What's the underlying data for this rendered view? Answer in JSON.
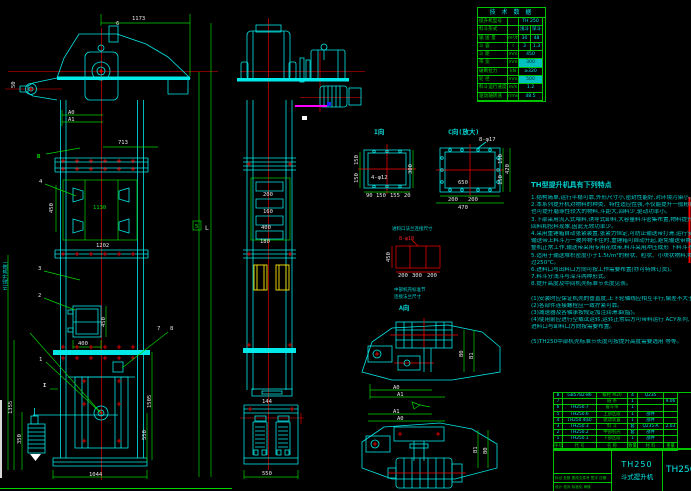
{
  "tech_table": {
    "title": "技 术 数 据",
    "rows": [
      {
        "label": "提升机型号",
        "unit": "",
        "v1": "TH 250",
        "v2": "",
        "span": true,
        "hl": false
      },
      {
        "label": "料斗形式",
        "unit": "",
        "v1": "浅斗",
        "v2": "深斗",
        "span": false,
        "hl": false
      },
      {
        "label": "输 送 量",
        "unit": "m³/h",
        "v1": "30",
        "v2": "48",
        "span": false,
        "hl": false
      },
      {
        "label": "斗  容",
        "unit": "l",
        "v1": "3",
        "v2": "1.3",
        "span": false,
        "hl": false
      },
      {
        "label": "斗  距",
        "unit": "mm",
        "v1": "450",
        "v2": "",
        "span": true,
        "hl": false
      },
      {
        "label": "带  宽",
        "unit": "mm",
        "v1": "300",
        "v2": "",
        "span": true,
        "hl": true
      },
      {
        "label": "破断拉力",
        "unit": "kN",
        "v1": "≥320",
        "v2": "",
        "span": true,
        "hl": false
      },
      {
        "label": "轮  径",
        "unit": "mm",
        "v1": "500",
        "v2": "",
        "span": true,
        "hl": true
      },
      {
        "label": "料斗运行速度",
        "unit": "m/s",
        "v1": "1.2",
        "v2": "",
        "span": true,
        "hl": false
      },
      {
        "label": "驱动轴转速",
        "unit": "r/min",
        "v1": "48.5",
        "v2": "",
        "span": true,
        "hl": false
      }
    ]
  },
  "features": {
    "title": "TH型提升机具有下列特点",
    "lines": [
      "1.结构简单,运行平稳可靠,外形尺寸小,密封性能好,对环境污染小。",
      "2.本系列提升机对物料的种类、特性适应性强,不仅能提升一般粉状、粒状物料,",
      "  也可提升磨琢性较大的物料,斗距大,回料少,驱动功率小。",
      "3.下部采用流入式喂料,诱导式卸料,大容量料斗密集布置,物料提升时几乎无",
      "  回料和挖料现象,因此无效功率少。",
      "4.采用重锤箱自动张紧装置,张紧力恒定,可防止输送带打滑,运行安全可靠,",
      "  输送带上料斗万一被异物卡住时,重锤箱可自动升起,避免输送带撕裂,保证",
      "  整机正常工作,输送带采用专用花纹带,料斗采用冲压成形 下料斗不易损坏。",
      "5.适用于输送堆积密度小于1.5t/m³的粉状、粒状、小块状物料,物料温度不超",
      "  过250℃。",
      "6.进料口与出料口方向可按工作需要布置(亦可特殊订货)。",
      "7.料斗分浅斗与深斗两种形式。",
      "8.提升高度及中间机壳标准节长度见表。",
      "",
      "(1)安装时应保证机壳的垂直度,上下轮轴线应相互平行,偏差不大于规定值。",
      "(2)各部件连接螺栓应一致拧紧可靠。",
      "(3)减速器及各轴承按规定加注润滑油(脂)。",
      "(4)使用前应进行空载试运转,运转正常后方可带料运行 ACY系列,",
      "  进料口与卸料口方向按需要布置。",
      "",
      "(5)TH250中部机壳标准节长度可按提升高度需要选用 等等。"
    ]
  },
  "bom": {
    "headers": [
      "序号",
      "代 号",
      "名 称",
      "数量",
      "材 料",
      "重量"
    ],
    "rows": [
      [
        "8",
        "GB5782-86",
        "螺栓 M20",
        "4",
        "Q235",
        ""
      ],
      [
        "7",
        "",
        "链 条",
        "1",
        "",
        "9.06"
      ],
      [
        "6",
        "TH250.7",
        "畚斗带",
        "1",
        "",
        ""
      ],
      [
        "5",
        "TH250.6",
        "上部区段",
        "1",
        "部件",
        ""
      ],
      [
        "4",
        "TH250.4(B)",
        "驱动装置",
        "1",
        "部件",
        ""
      ],
      [
        "3",
        "TH250.3",
        "料 斗",
        "套",
        "Q235-A",
        "2.03"
      ],
      [
        "2",
        "TH250.2",
        "中部机壳",
        "套",
        "部件",
        ""
      ],
      [
        "1",
        "TH250.1",
        "下部区段",
        "1",
        "部件",
        ""
      ]
    ]
  },
  "title_block": {
    "model": "TH250",
    "product": "斗式提升机",
    "drawing_no": "TH250",
    "rev_row": "标记 处数 更改文件号 签字 日期",
    "design_row": "设计  校对  标准化  审核"
  },
  "labels": {
    "d1173": "1173",
    "d713": "713",
    "d450": "450",
    "d1130": "1130",
    "d1202": "1202",
    "d400": "400",
    "door_h": "450",
    "d1355": "1355",
    "d350": "350",
    "d1044": "1044",
    "d1505": "1505",
    "d550": "550",
    "d50": "50",
    "a0": "A0",
    "a1": "A1",
    "dimL": "L",
    "item5": "5",
    "hline": "H(提升高度)",
    "p1": "1",
    "p2": "2",
    "p3": "3",
    "p4": "4",
    "p6": "6",
    "p7": "7",
    "p8": "8",
    "viewB": "B",
    "secI": "I",
    "s200": "200",
    "s160": "160",
    "s400": "400",
    "s180": "180",
    "s144": "144",
    "s550": "550",
    "di_title": "I向",
    "di_holes": "4-φ12",
    "di_150a": "150",
    "di_150b": "150",
    "di_300": "300",
    "di_b1": "90",
    "di_b2": "150",
    "di_b3": "155",
    "di_b4": "20",
    "dc_title": "C向(放大)",
    "dc_holes": "8-φ17",
    "dc_650": "650",
    "dc_150a": "150",
    "dc_150b": "150",
    "dc_420": "420",
    "dc_b1": "200",
    "dc_b2": "200",
    "dc_b3": "470",
    "fl_title": "进料口法兰连接尺寸",
    "fl_holes": "8-φ18",
    "fl_450": "450",
    "fl_b1": "200",
    "fl_b2": "300",
    "fl_b3": "200",
    "note1": "中部机壳标准节",
    "note2": "连接法兰尺寸",
    "viewA": "A向",
    "ta_a0": "A0",
    "ta_a1": "A1",
    "ta_b0": "B0",
    "ta_b1": "B1",
    "tb_a0": "A0",
    "tb_a1": "A1",
    "tb_b0": "B1",
    "tb_b1": "B0"
  }
}
